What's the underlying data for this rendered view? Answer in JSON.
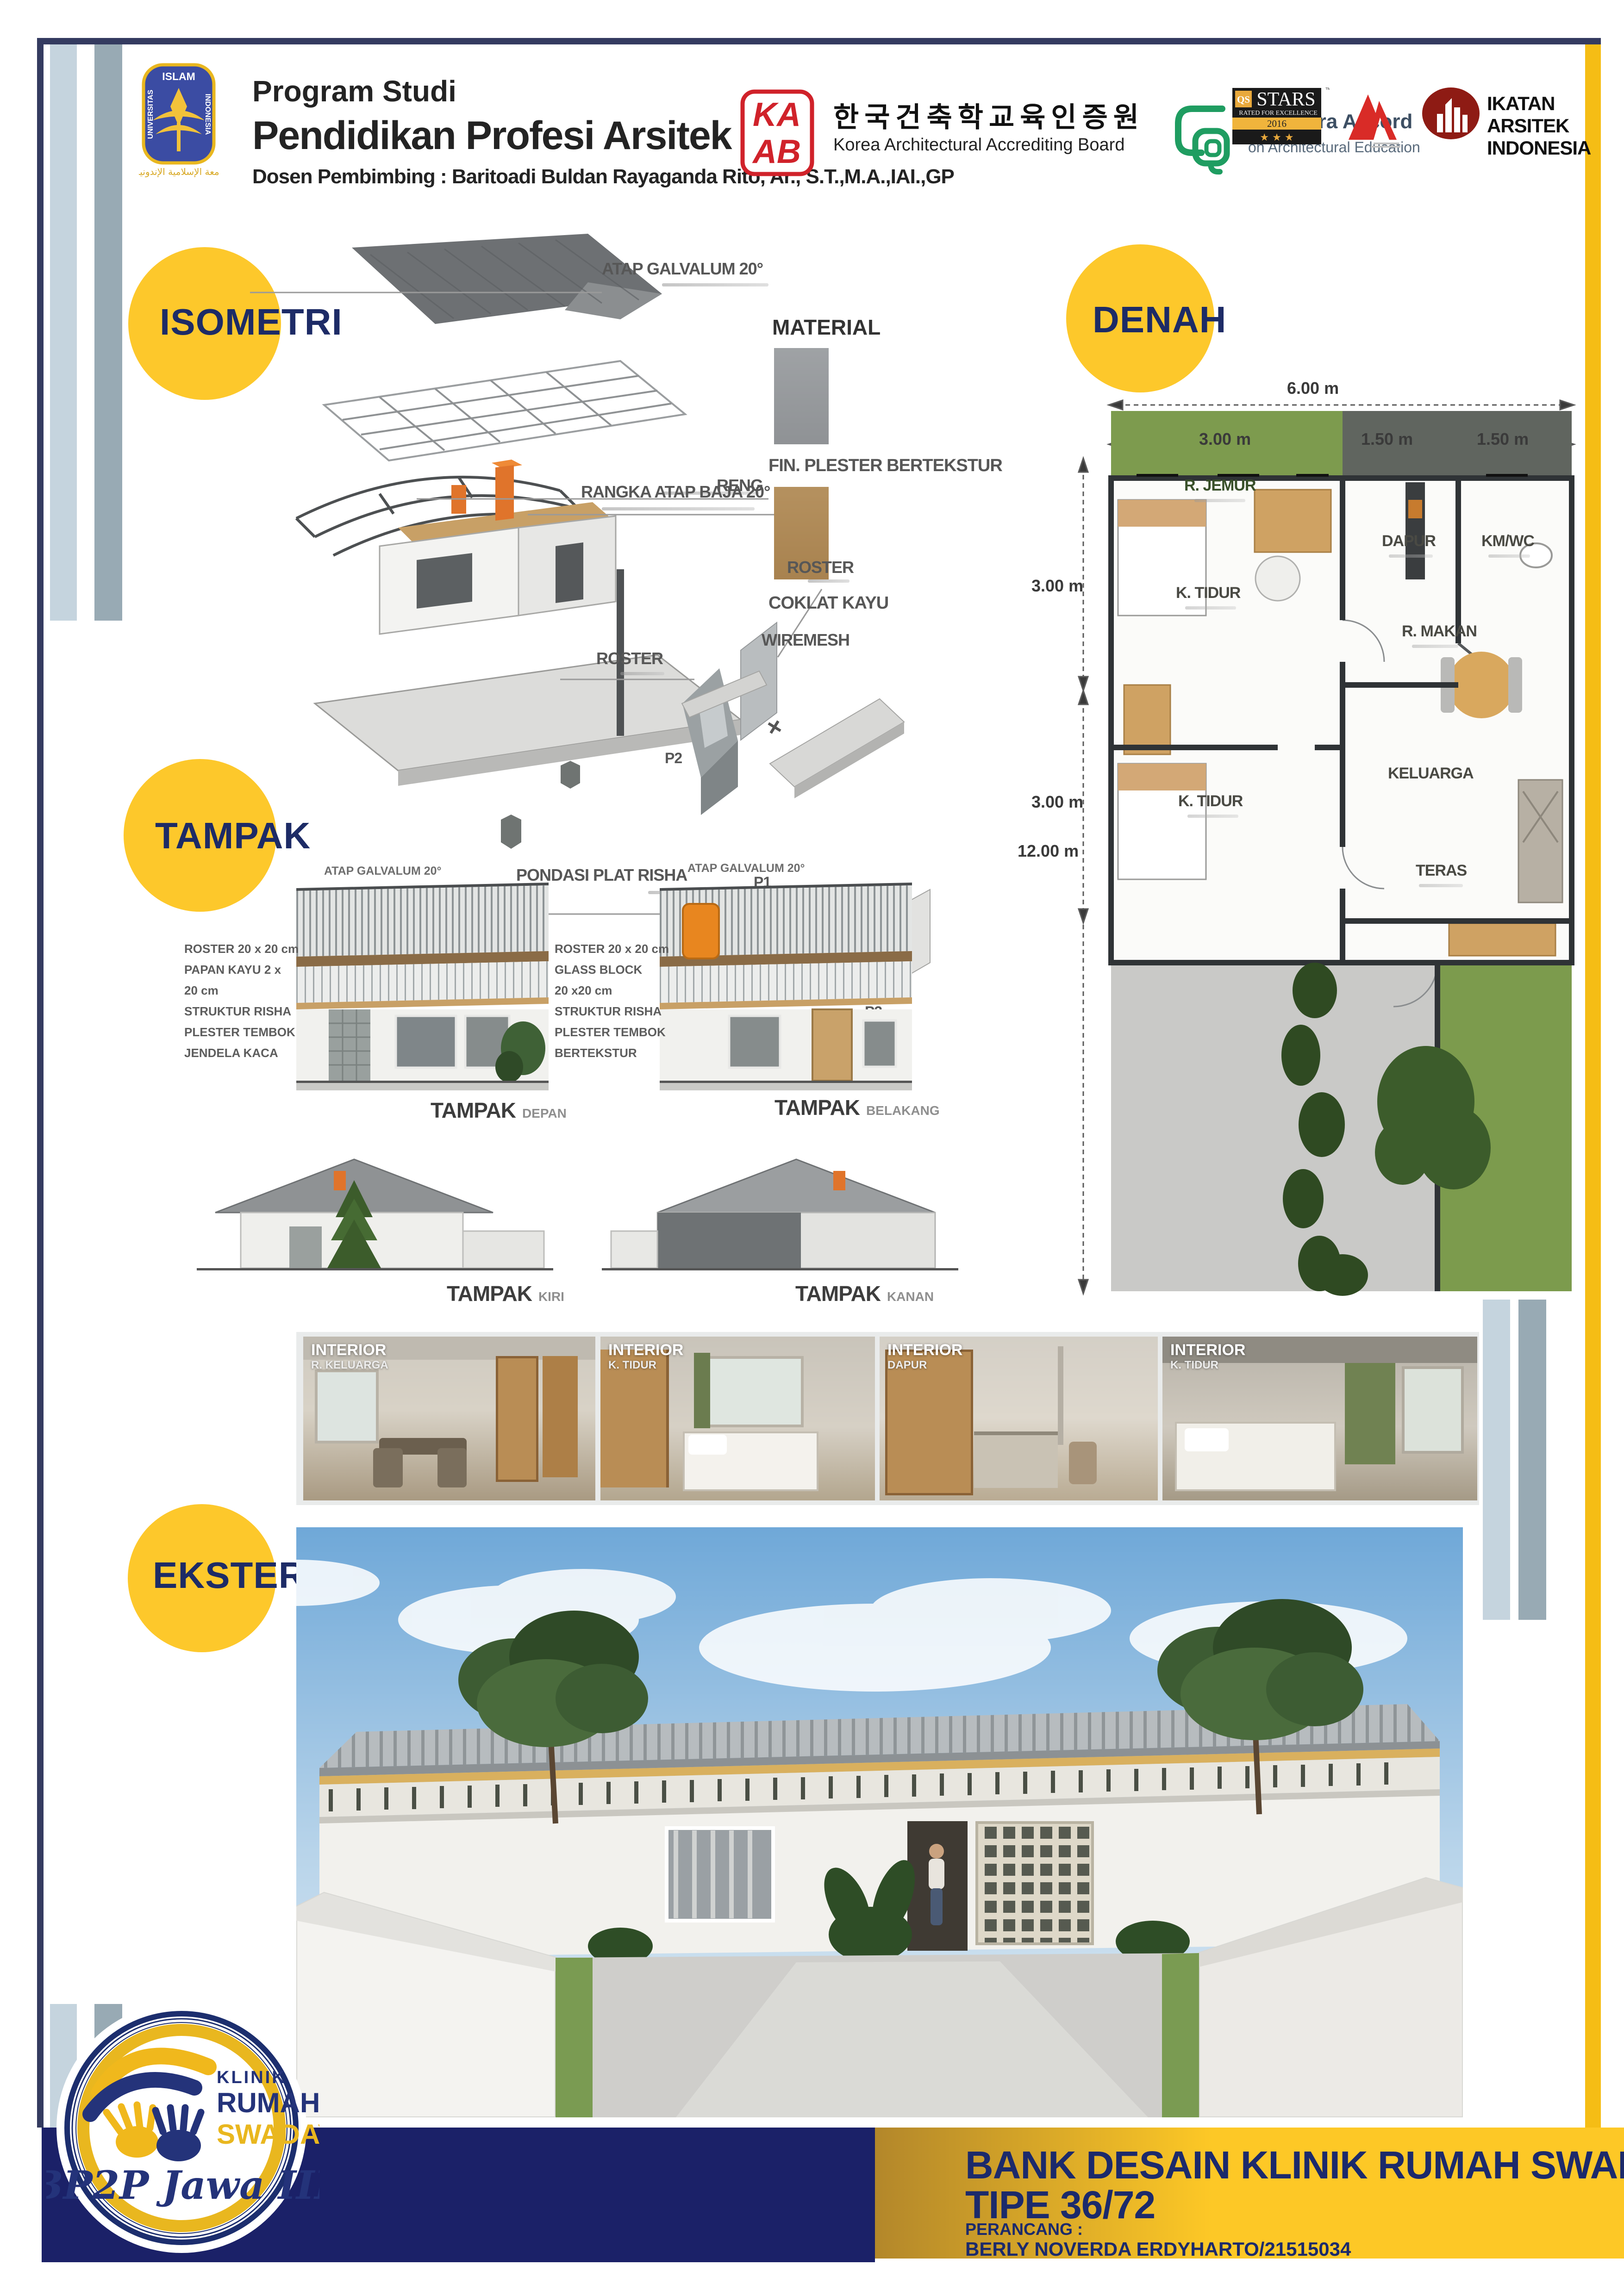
{
  "colors": {
    "navy": "#1d2b66",
    "gold": "#fdc826",
    "band_navy": "#1b2168",
    "border_navy": "#343b60",
    "stripe_light": "#c5d4de",
    "stripe_gray": "#98aab4",
    "right_stripe_yellow": "#f5bd15",
    "kaab_red": "#d0222a",
    "canberra_green": "#1f9d61",
    "iai_maroon": "#8e1b14"
  },
  "header": {
    "uii": {
      "islam": "ISLAM",
      "universitas": "UNIVERSITAS",
      "indonesia": "INDONESIA",
      "calligraphy": "الجامعة الإسلامية الإندونيسية"
    },
    "program_line1": "Program Studi",
    "program_line2": "Pendidikan Profesi Arsitek",
    "supervisor": "Dosen Pembimbing : Baritoadi Buldan Rayaganda Rito, Ar., S.T.,M.A.,IAI.,GP",
    "kaab": {
      "ka": "KA",
      "ab": "AB",
      "korean": "한국건축학교육인증원",
      "english": "Korea Architectural Accrediting Board"
    },
    "canberra": {
      "name": "Canberra Accord",
      "subtitle": "on Architectural Education"
    },
    "qs": {
      "qs": "QS",
      "stars": "STARS",
      "rated": "RATED FOR EXCELLENCE",
      "year": "2016",
      "tm": "™",
      "star3": "★ ★ ★"
    },
    "iai": {
      "line1": "IKATAN",
      "line2": "ARSITEK",
      "line3": "INDONESIA"
    }
  },
  "sections": {
    "isometri": "ISOMETRI",
    "denah": "DENAH",
    "tampak": "TAMPAK",
    "eksterior": "EKSTERIOR"
  },
  "isometri": {
    "atap": "ATAP GALVALUM 20°",
    "material": "MATERIAL",
    "fin": "FIN. PLESTER BERTEKSTUR",
    "coklat": "COKLAT KAYU",
    "reng": "RENG",
    "rangka": "RANGKA ATAP BAJA 20°",
    "roster_top": "ROSTER",
    "wiremesh": "WIREMESH",
    "roster_left": "ROSTER",
    "pondasi": "PONDASI PLAT RISHA",
    "p1": "P1",
    "p2": "P2",
    "p3": "P3"
  },
  "denah": {
    "dim_top_total": "6.00 m",
    "dim_top_1": "3.00 m",
    "dim_top_2": "1.50 m",
    "dim_top_3": "1.50 m",
    "dim_left_1": "3.00 m",
    "dim_left_2": "3.00 m",
    "dim_left_total": "12.00 m",
    "room_jemur": "R. JEMUR",
    "room_dapur": "DAPUR",
    "room_kmwc": "KM/WC",
    "room_tidur1": "K. TIDUR",
    "room_makan": "R. MAKAN",
    "room_keluarga": "KELUARGA",
    "room_tidur2": "K. TIDUR",
    "room_teras": "TERAS"
  },
  "tampak": {
    "atap_note": "ATAP GALVALUM 20°",
    "left_annotations": [
      "ROSTER 20 x 20 cm",
      "PAPAN KAYU 2 x",
      "20 cm",
      "STRUKTUR RISHA",
      "PLESTER TEMBOK",
      "JENDELA KACA"
    ],
    "right_annotations": [
      "ROSTER 20 x 20 cm",
      "GLASS BLOCK",
      "20 x20 cm",
      "STRUKTUR RISHA",
      "PLESTER TEMBOK",
      "BERTEKSTUR"
    ],
    "labels": [
      {
        "main": "TAMPAK",
        "sub": "DEPAN"
      },
      {
        "main": "TAMPAK",
        "sub": "BELAKANG"
      },
      {
        "main": "TAMPAK",
        "sub": "KIRI"
      },
      {
        "main": "TAMPAK",
        "sub": "KANAN"
      }
    ]
  },
  "interior": {
    "tag": "INTERIOR",
    "rooms": [
      "R. KELUARGA",
      "K. TIDUR",
      "DAPUR",
      "K. TIDUR"
    ]
  },
  "footer": {
    "title": "BANK DESAIN KLINIK RUMAH SWADAYA",
    "tipe": "TIPE 36/72",
    "perancang_label": "PERANCANG :",
    "perancang_name": "BERLY NOVERDA ERDYHARTO/21515034"
  },
  "badge": {
    "klinik": "KLINIK",
    "rumah": "RUMAH",
    "swadaya": "SWADAYA",
    "bp2p": "BP2P Jawa III"
  }
}
